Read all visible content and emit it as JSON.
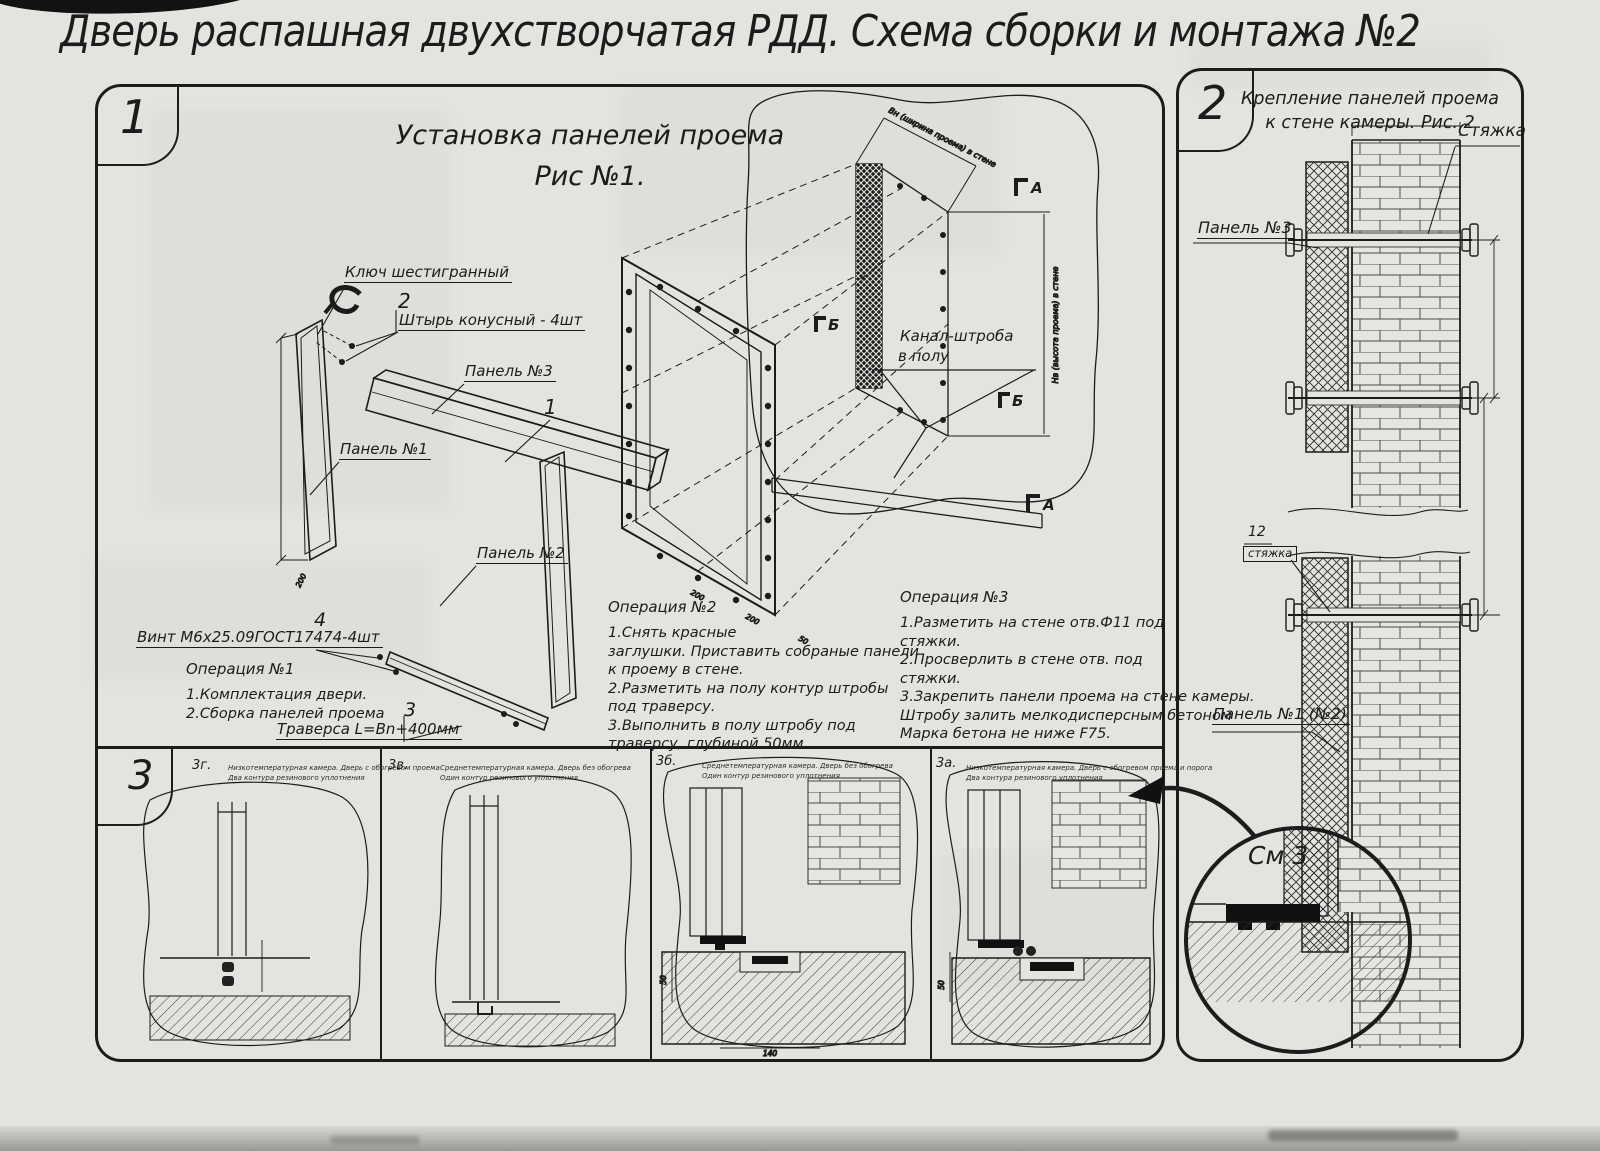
{
  "title": "Дверь распашная двухстворчатая РДД.  Схема сборки и монтажа №2",
  "fig1": {
    "num": "1",
    "title1": "Установка панелей проема",
    "title2": "Рис №1.",
    "labels": {
      "key": "Ключ шестигранный",
      "pin_no": "2",
      "pin": "Штырь конусный - 4шт",
      "panel3": "Панель №3",
      "item1": "1",
      "panel1": "Панель №1",
      "panel2": "Панель №2",
      "screw_no": "4",
      "screw": "Винт М6х25.09ГОСТ17474-4шт",
      "trav_no": "3",
      "traverse": "Траверса  L=Bn+400мм",
      "channel1": "Канал-штроба",
      "channel2": "в полу",
      "sec_a": "А",
      "sec_b": "Б"
    },
    "dims": {
      "top": "Вн (ширина проема) в стене",
      "right": "Нв (высота проема) в стене",
      "d200": "200",
      "d50": "50"
    },
    "op1_title": "Операция №1",
    "op1": [
      "1.Комплектация двери.",
      "2.Сборка панелей проема"
    ],
    "op2_title": "Операция №2",
    "op2": [
      "1.Снять красные",
      "заглушки. Приставить собраные панели",
      "к проему в стене.",
      "2.Разметить на полу контур штробы",
      "под траверсу.",
      "3.Выполнить в полу штробу под",
      "траверсу, глубиной 50мм."
    ],
    "op3_title": "Операция №3",
    "op3": [
      "1.Разметить на стене отв.Ф11 под",
      "стяжки.",
      "2.Просверлить в стене отв.  под",
      "стяжки.",
      "3.Закрепить панели проема на стене камеры.",
      "Штробу залить мелкодисперсным бетоном",
      "Марка бетона не ниже  F75."
    ]
  },
  "fig2": {
    "num": "2",
    "title1": "Крепление панелей проема",
    "title2": "к стене камеры. Рис. 2",
    "labels": {
      "tie": "Стяжка",
      "panel3": "Панель №3",
      "tie_no": "12",
      "tie_boxed": "стяжка",
      "panel12": "Панель №1 (№2)",
      "see": "См 3"
    }
  },
  "fig3": {
    "num": "3",
    "details": [
      {
        "id": "3г.",
        "line1": "Низкотемпературная камера. Дверь с обогревом проема",
        "line2": "Два контура резинового уплотнения"
      },
      {
        "id": "3в.",
        "line1": "Среднетемпературная камера. Дверь без обогрева",
        "line2": "Один контур резинового уплотнения"
      },
      {
        "id": "3б.",
        "line1": "Среднетемпературная камера. Дверь без обогрева",
        "line2": "Один контур резинового уплотнения"
      },
      {
        "id": "3а.",
        "line1": "Низкотемпературная камера. Дверь с обогревом проема и порога",
        "line2": "Два контура резинового уплотнения"
      }
    ],
    "dims": {
      "d50": "50",
      "d140": "140"
    }
  },
  "colors": {
    "ink": "#1c1c1c",
    "paper": "#e4e3df"
  }
}
